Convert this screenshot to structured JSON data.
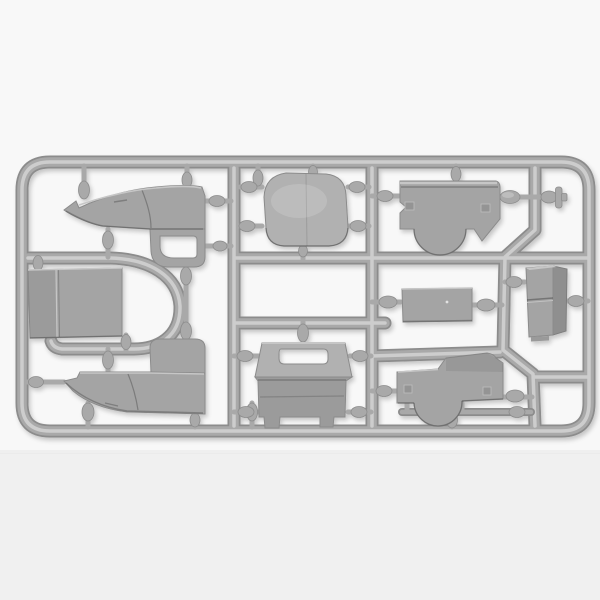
{
  "scene": {
    "description": "Gray plastic injection-molded sprue (parts tree) from a scale model truck kit, photographed on a white background. The runner frame holds cab side panels, a roof, fenders, a floor panel, a seat box, a flat plate, a tank box and a small pin, attached by teardrop-shaped gates.",
    "frame_label": "Sprue runner frame with gates",
    "background_label": "White photo background"
  },
  "colors": {
    "bg": "#f8f8f8",
    "band": "#eeeeee",
    "rail": "#a9a9a9",
    "rail_hi": "#cdcdcd",
    "rail_dark": "#8c8c8c",
    "part": "#a4a4a4",
    "part_light": "#b1b1b1",
    "part_dark": "#8b8b8b",
    "part_dark2": "#9b9b9b",
    "part_hi": "#c6c6c6"
  },
  "parts": [
    {
      "id": "cab-side-right",
      "label": "Cab side panel, right (window at bottom)"
    },
    {
      "id": "cab-side-left",
      "label": "Cab side panel, left (window at top)"
    },
    {
      "id": "roof-panel",
      "label": "Cab roof panel"
    },
    {
      "id": "fender-right",
      "label": "Fender with wheel-arch cutout, upper right"
    },
    {
      "id": "fender-left",
      "label": "Fender with wheel-arch cutout, lower right"
    },
    {
      "id": "floor-panel",
      "label": "Flat floor / door panel with seam"
    },
    {
      "id": "seat-box",
      "label": "Seat box / cowl with hand slot"
    },
    {
      "id": "flat-plate",
      "label": "Flat rectangular plate"
    },
    {
      "id": "tank-box",
      "label": "Fuel tank / battery box"
    },
    {
      "id": "pin-part",
      "label": "Small round-head pin"
    }
  ]
}
